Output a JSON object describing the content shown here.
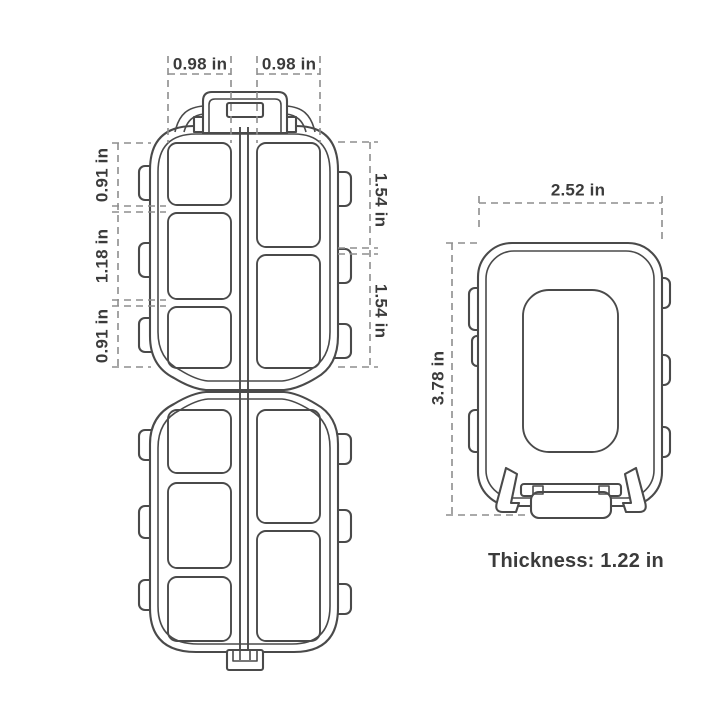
{
  "colors": {
    "line": "#4a4a4a",
    "dashed": "#8e8e8e",
    "text": "#3b3b3b",
    "background": "#ffffff"
  },
  "open_view": {
    "dim_top_left": "0.98 in",
    "dim_top_right": "0.98 in",
    "dim_left_top": "0.91 in",
    "dim_left_middle": "1.18 in",
    "dim_left_bottom": "0.91 in",
    "dim_right_top": "1.54 in",
    "dim_right_bottom": "1.54 in"
  },
  "closed_view": {
    "dim_width": "2.52 in",
    "dim_height": "3.78 in",
    "thickness_label": "Thickness: 1.22 in"
  }
}
